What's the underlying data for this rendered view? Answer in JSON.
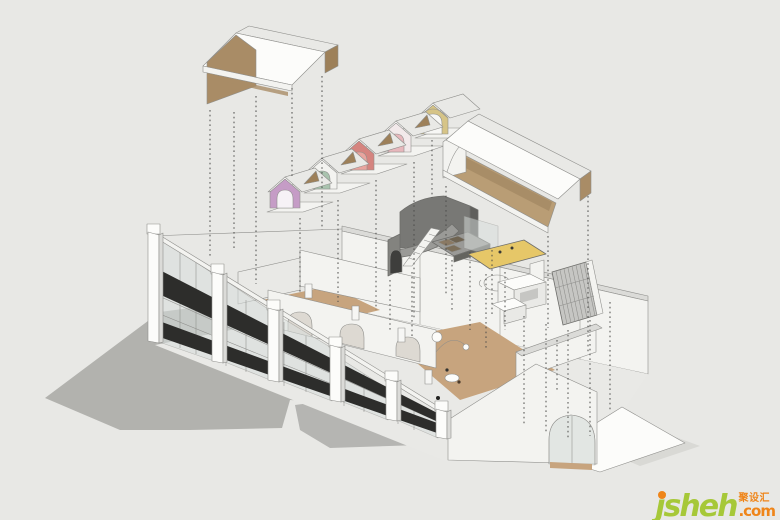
{
  "meta": {
    "scene_type": "exploded-axonometric-interior-rendering",
    "background_color": "#e8e8e5"
  },
  "watermark": {
    "brand": "jsheh",
    "tld": ".com",
    "cjk": "聚设汇",
    "green": "#a6c838",
    "orange": "#ef8519"
  },
  "palette": {
    "background": "#e8e8e5",
    "shadow": "#a8a8a5",
    "shadow_soft": "#c9c9c6",
    "signage_band": "#2d2d2b",
    "glass": "#d8dedc",
    "wood_roof": "#a98c66",
    "wood_roof_dark": "#9d8059",
    "wood_ceiling": "#b99d75",
    "wood_floor": "#c7a47e",
    "wood_floor_light": "#d2b38f",
    "arch_frame": "#9c7a52",
    "hut_lavender": "#c59cc6",
    "hut_sage": "#a9c3ae",
    "hut_salmon": "#d5847f",
    "hut_salmon_arch": "#e8a49e",
    "hut_blush": "#e7b7bc",
    "hut_blush_face": "#f2e9ea",
    "hut_khaki": "#d6c487",
    "mat_yellow": "#e6c768",
    "stair_gray": "#787875"
  },
  "components": [
    "ground-shadow",
    "curtain-wall-facade",
    "signage-band",
    "interior-partitions",
    "entry-arch",
    "small-gable-roof",
    "lavender-vault-hut",
    "sage-vault-hut",
    "salmon-vault-hut",
    "blush-vault-hut",
    "khaki-vault-hut",
    "large-gable-roof",
    "stair-volume",
    "mezzanine-mat",
    "round-table",
    "service-counters",
    "slatted-screen",
    "leader-lines",
    "watermark-logo"
  ]
}
